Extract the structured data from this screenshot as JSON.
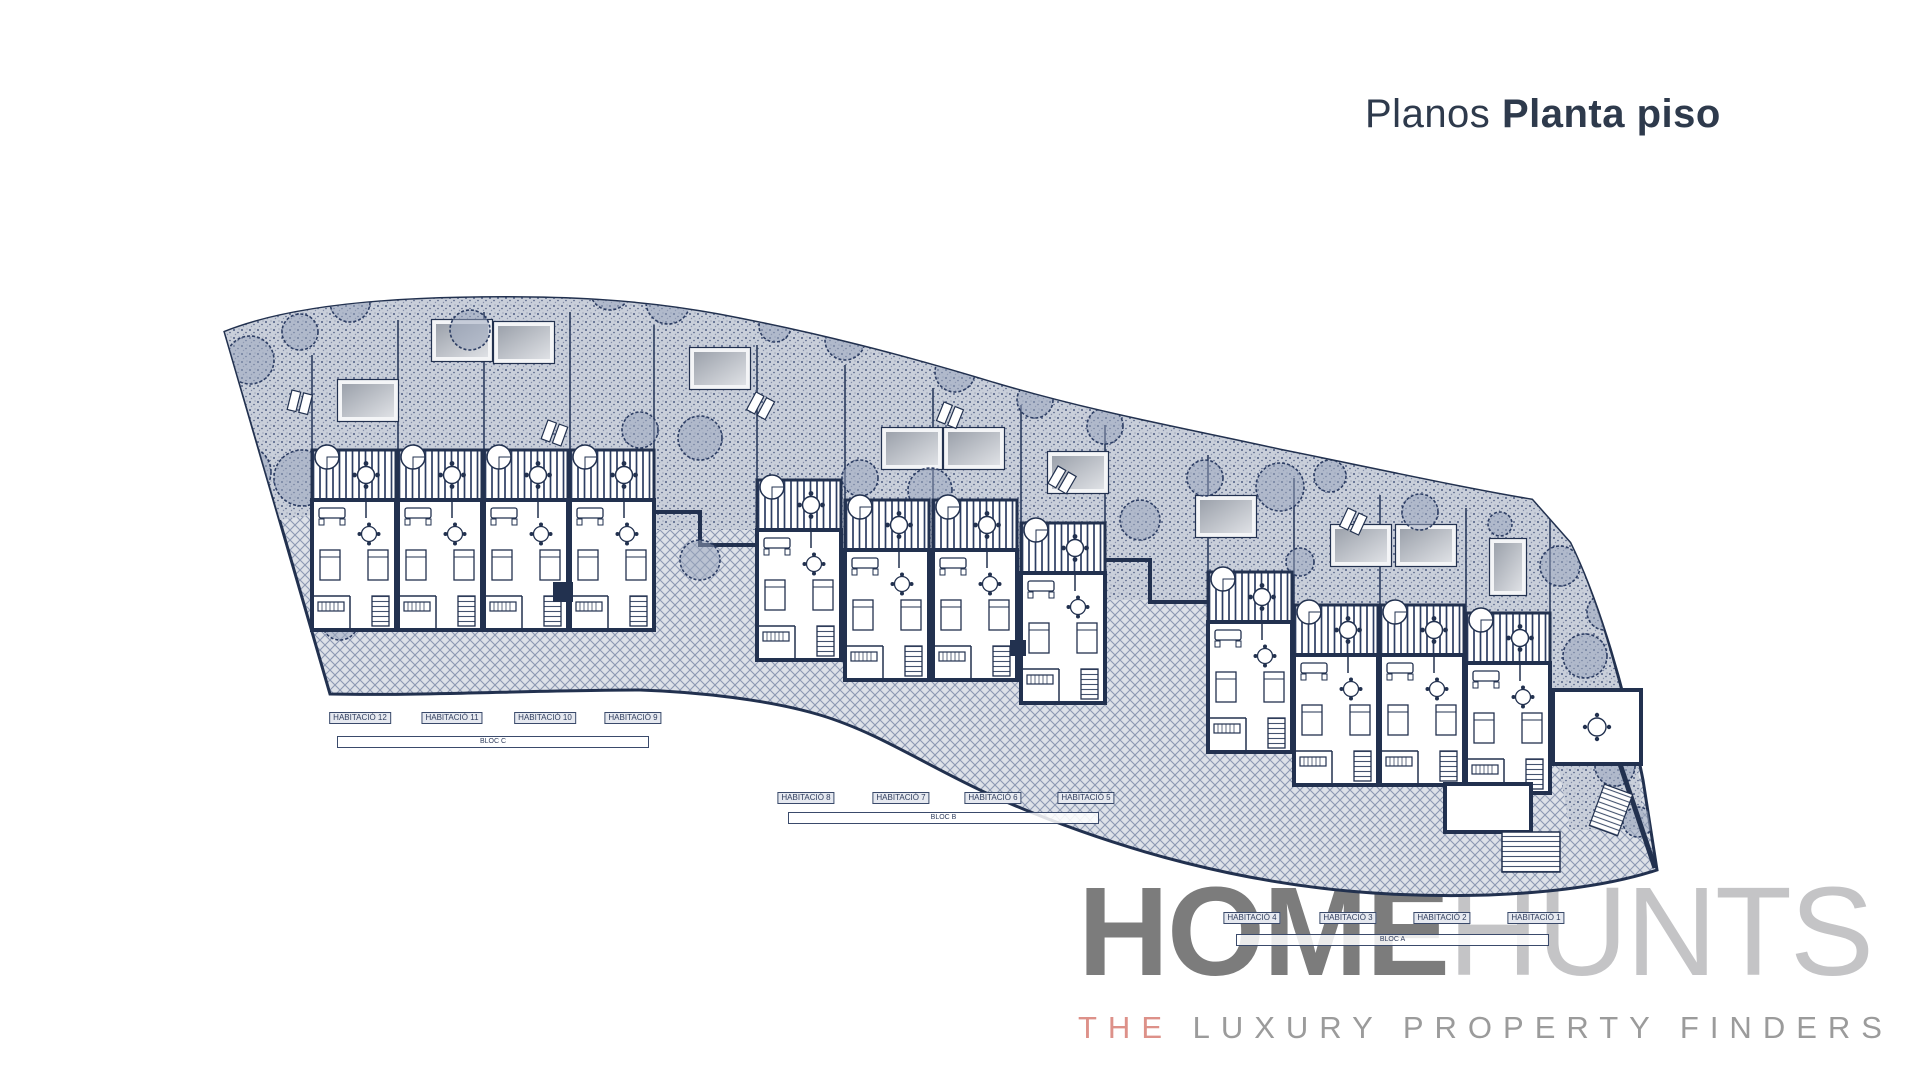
{
  "header": {
    "title_light": "Planos",
    "title_bold": "Planta piso",
    "title_color": "#2e3a4c"
  },
  "plan": {
    "blocks": [
      {
        "bar": "BLOC C",
        "labels": [
          "HABITACIÓ 12",
          "HABITACIÓ 11",
          "HABITACIÓ 10",
          "HABITACIÓ 9"
        ]
      },
      {
        "bar": "BLOC B",
        "labels": [
          "HABITACIÓ 8",
          "HABITACIÓ 7",
          "HABITACIÓ 6",
          "HABITACIÓ 5"
        ]
      },
      {
        "bar": "BLOC A",
        "labels": [
          "HABITACIÓ 4",
          "HABITACIÓ 3",
          "HABITACIÓ 2",
          "HABITACIÓ 1"
        ]
      }
    ],
    "colors": {
      "ink": "#22314f",
      "garden_fill": "#c9cfda",
      "garden_dot": "#4d5c82",
      "slope_fill": "#dde1e8",
      "slope_line": "#8c98b2",
      "skylight_dark": "#989ea8",
      "skylight_light": "#e2e4e8"
    }
  },
  "logo": {
    "word_primary": "HOME",
    "word_secondary": "HUNTS",
    "tagline_accent": "THE",
    "tagline_rest": " LUXURY PROPERTY FINDERS",
    "primary_color": "#7c7c7c",
    "secondary_color": "#c4c4c6",
    "accent_color": "#dd9189"
  }
}
